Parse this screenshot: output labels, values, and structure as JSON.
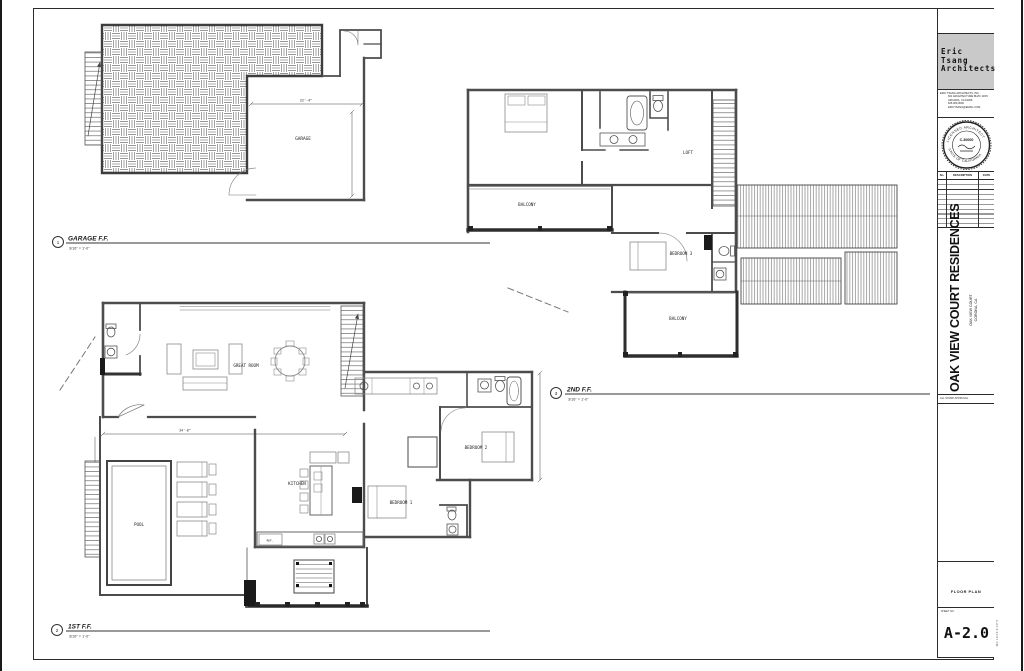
{
  "sheet": {
    "plot_stamp": "6-24 2:41:07 PM"
  },
  "titleblock": {
    "logo_lines": [
      "Eric",
      "Tsang",
      "Architects"
    ],
    "firm_lines": [
      "ERIC TSANG ARCHITECTS, INC.",
      "601 ARCHITECTURE BLVD. #215",
      "ARCADIA, CA 91006",
      "626.000.0000",
      "ERICTSANG@EMAIL.COM"
    ],
    "stamp_top": "LICENSED ARCHITECT",
    "stamp_bottom": "STATE OF CALIFORNIA",
    "stamp_center": "C-30000",
    "rev_headers": [
      "No.",
      "DESCRIPTION",
      "DATE"
    ],
    "project_title": "OAK VIEW COURT RESIDENCES",
    "project_address_1": "OAK VIEW COURT",
    "project_address_2": "CORONA, CA",
    "approval_note": "ALL STAMP APPROVAL",
    "sheet_title": "FLOOR PLAN",
    "sheet_no_label": "SHEET NO.",
    "sheet_no": "A-2.0"
  },
  "plans": [
    {
      "number": "1",
      "title": "GARAGE F.F.",
      "scale": "3/16\" = 1'-0\"",
      "rooms": {
        "garage": "GARAGE"
      },
      "dims": [
        "22'-4\""
      ]
    },
    {
      "number": "2",
      "title": "1ST F.F.",
      "scale": "3/16\" = 1'-0\"",
      "rooms": {
        "great": "GREAT ROOM",
        "kitchen": "KITCHEN",
        "ref": "REF.",
        "pool": "POOL",
        "bed1": "BEDROOM 1",
        "bed2": "BEDROOM 2"
      },
      "dims": [
        "34'-8\""
      ]
    },
    {
      "number": "3",
      "title": "2ND F.F.",
      "scale": "3/16\" = 1'-0\"",
      "rooms": {
        "loft": "LOFT",
        "balcony_front": "BALCONY",
        "bed3": "BEDROOM 3",
        "balcony_rear": "BALCONY"
      }
    }
  ]
}
